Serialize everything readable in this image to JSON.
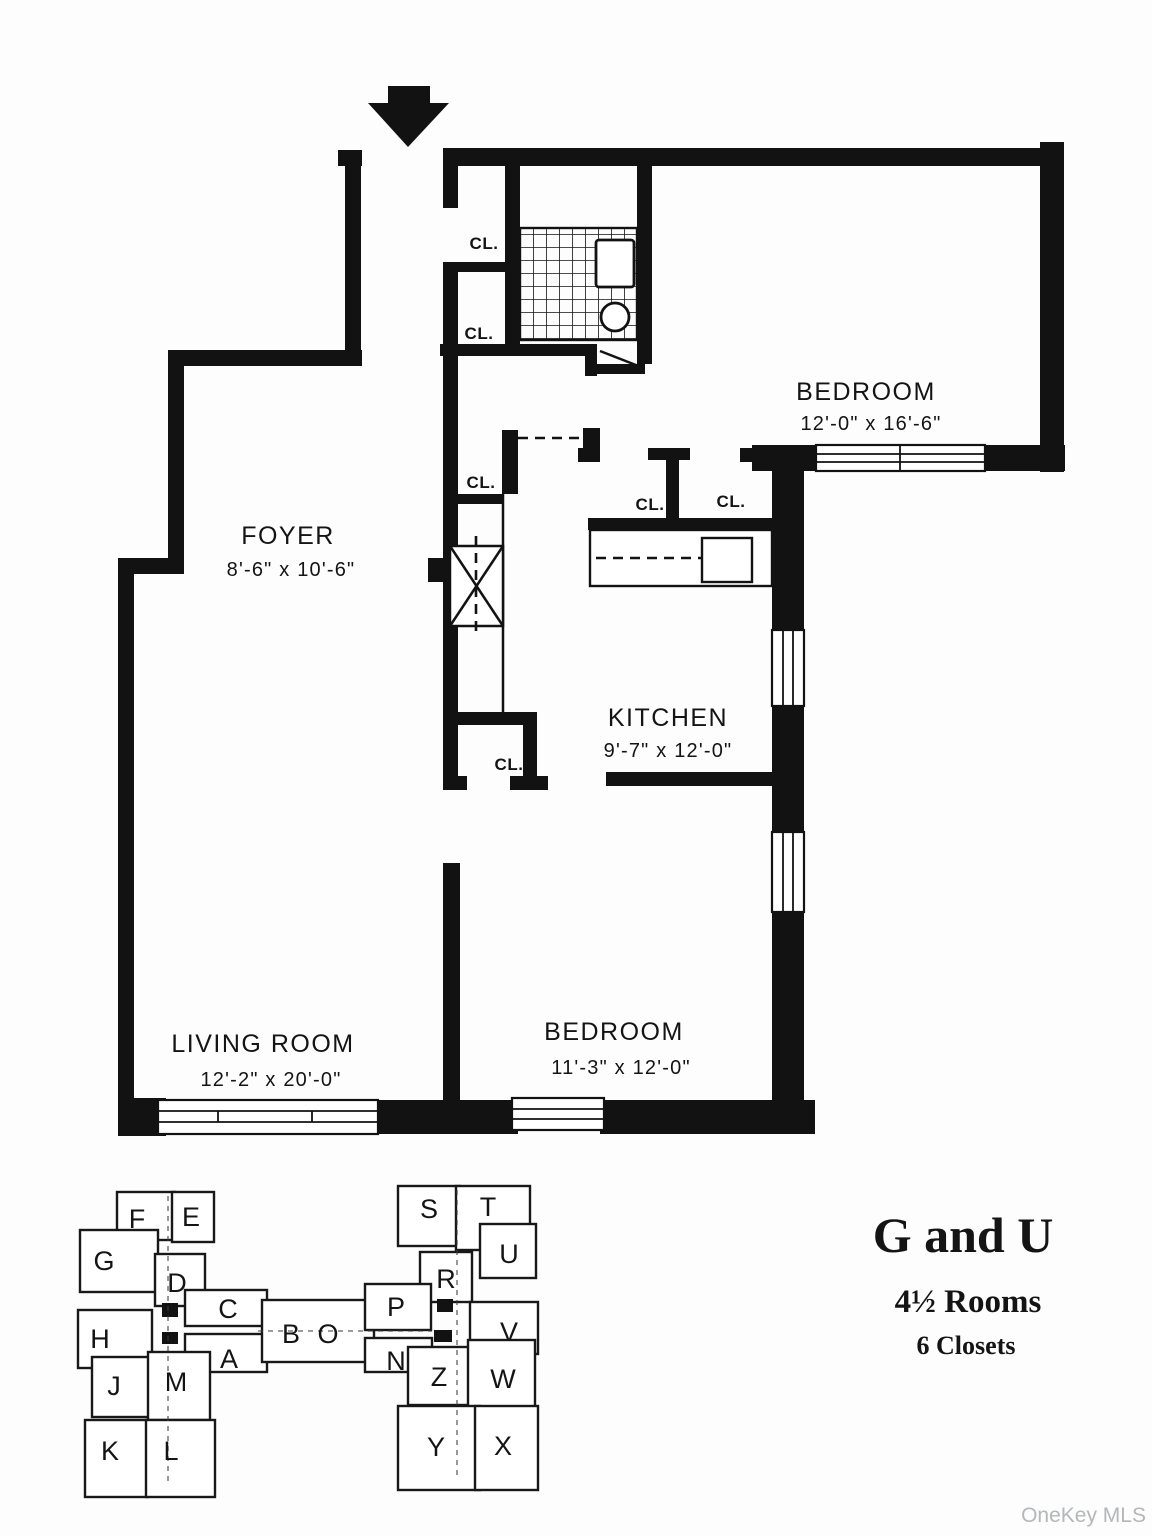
{
  "plan": {
    "icons": {
      "entrance_arrow": "down-arrow"
    },
    "rooms": {
      "foyer": {
        "name": "FOYER",
        "dims": "8'-6\" x 10'-6\""
      },
      "bedroom_top": {
        "name": "BEDROOM",
        "dims": "12'-0\" x 16'-6\""
      },
      "kitchen": {
        "name": "KITCHEN",
        "dims": "9'-7\" x 12'-0\""
      },
      "living_room": {
        "name": "LIVING ROOM",
        "dims": "12'-2\" x 20'-0\""
      },
      "bedroom_bottom": {
        "name": "BEDROOM",
        "dims": "11'-3\" x 12'-0\""
      }
    },
    "closets": {
      "c1": "CL.",
      "c2": "CL.",
      "c3": "CL.",
      "c4": "CL.",
      "c5": "CL.",
      "c6": "CL."
    }
  },
  "key_plan": {
    "units": {
      "F": "F",
      "E": "E",
      "G": "G",
      "D": "D",
      "C": "C",
      "B": "B",
      "O": "O",
      "H": "H",
      "A": "A",
      "J": "J",
      "M": "M",
      "K": "K",
      "L": "L",
      "S": "S",
      "T": "T",
      "U": "U",
      "R": "R",
      "P": "P",
      "V": "V",
      "N": "N",
      "Z": "Z",
      "W": "W",
      "Y": "Y",
      "X": "X"
    }
  },
  "legend": {
    "title": "G and U",
    "rooms": "4½ Rooms",
    "closets": "6 Closets"
  },
  "watermark": "OneKey MLS"
}
